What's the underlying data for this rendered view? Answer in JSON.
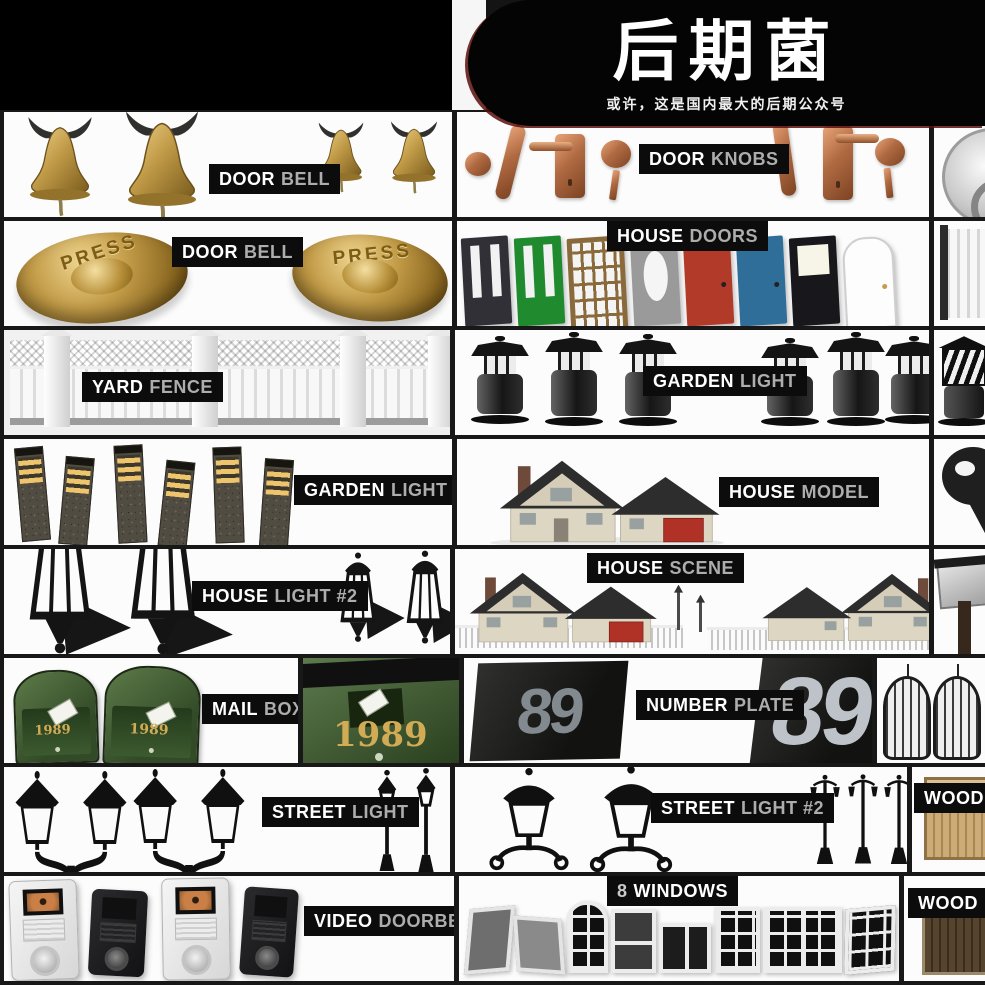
{
  "header": {
    "title": "后期菌",
    "subtitle": "或许，这是国内最大的后期公众号"
  },
  "cells": {
    "door_bell_hanging": {
      "label_strong": "DOOR",
      "label_light": "BELL"
    },
    "door_knobs": {
      "label_strong": "DOOR",
      "label_light": "KNOBS"
    },
    "door_bell_press": {
      "label_strong": "DOOR",
      "label_light": "BELL",
      "button_text": "PRESS"
    },
    "house_doors": {
      "label_strong": "HOUSE",
      "label_light": "DOORS"
    },
    "yard_fence": {
      "label_strong": "YARD",
      "label_light": "FENCE"
    },
    "garden_light": {
      "label_strong": "GARDEN",
      "label_light": "LIGHT"
    },
    "garden_light_3": {
      "label_strong": "GARDEN",
      "label_light": "LIGHT #3"
    },
    "house_model": {
      "label_strong": "HOUSE",
      "label_light": "MODEL"
    },
    "house_light_2": {
      "label_strong": "HOUSE",
      "label_light": "LIGHT #2"
    },
    "house_scene": {
      "label_strong": "HOUSE",
      "label_light": "SCENE"
    },
    "mail_box": {
      "label_strong": "MAIL",
      "label_light": "BOX",
      "year": "1989"
    },
    "mail_box_large": {
      "year": "1989"
    },
    "number_plate": {
      "label_strong": "NUMBER",
      "label_light": "PLATE",
      "number": "89"
    },
    "street_light": {
      "label_strong": "STREET",
      "label_light": "LIGHT"
    },
    "street_light_2": {
      "label_strong": "STREET",
      "label_light": "LIGHT #2"
    },
    "wooden_fence": {
      "label_partial": "WOODE"
    },
    "video_doorbell": {
      "label_strong": "VIDEO",
      "label_light": "DOORBELL"
    },
    "windows": {
      "label_prefix": "8",
      "label_strong": "WINDOWS"
    },
    "wooden_gate": {
      "label_partial": "WOOD"
    }
  },
  "colors": {
    "header_bg": "#000000",
    "badge_bg": "#0c0c0c",
    "badge_secondary": "#adadad",
    "brass": "#b5913f",
    "copper": "#b06a42",
    "mailbox_green": "#3e5a33",
    "gold_year": "#d2ab55",
    "door_red": "#b23a28",
    "door_blue": "#2f6e99",
    "door_green": "#1f8a2e",
    "door_wood": "#8a6a3a",
    "plate_digit": "#8b9198"
  }
}
